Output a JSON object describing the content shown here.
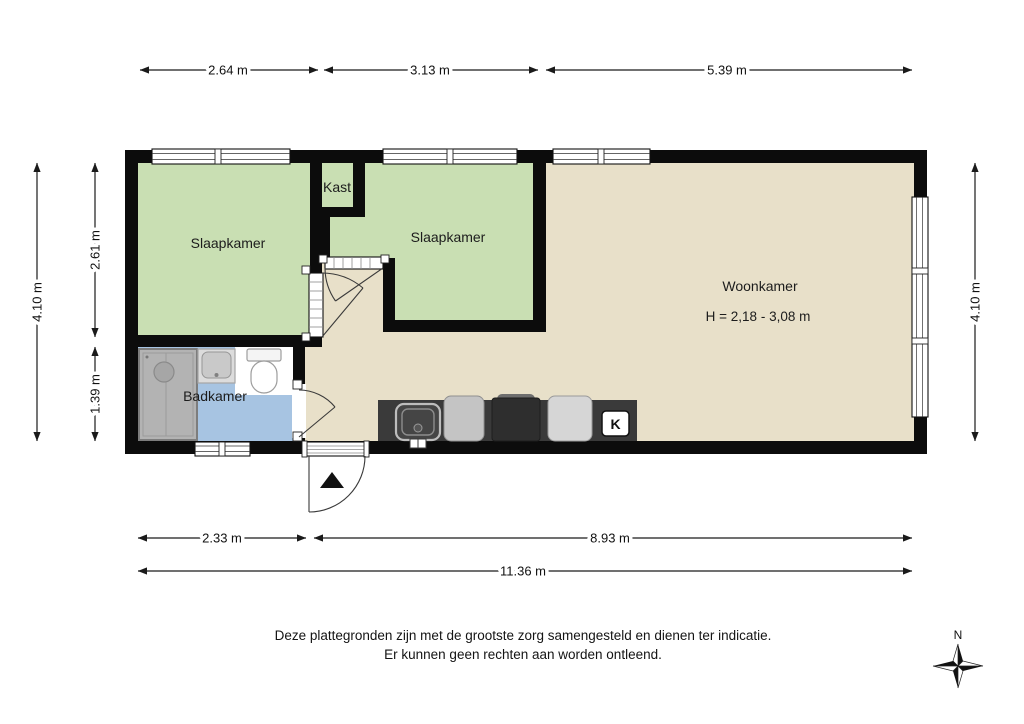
{
  "plan": {
    "rooms": {
      "slaapkamer_left": {
        "label": "Slaapkamer"
      },
      "kast": {
        "label": "Kast"
      },
      "slaapkamer_mid": {
        "label": "Slaapkamer"
      },
      "woonkamer": {
        "label": "Woonkamer",
        "height_note": "H = 2,18 - 3,08 m"
      },
      "badkamer": {
        "label": "Badkamer"
      }
    },
    "kitchen": {
      "boiler_label": "K"
    },
    "colors": {
      "wall": "#0c0c0c",
      "bedroom_green": "#c9dfb3",
      "living_beige": "#e8e0c9",
      "bathroom_blue": "#a7c4e2",
      "counter_dark": "#3a3a3a"
    }
  },
  "dimensions": {
    "top": [
      "2.64 m",
      "3.13 m",
      "5.39 m"
    ],
    "left_outer": "4.10 m",
    "left_inner": [
      "2.61 m",
      "1.39 m"
    ],
    "right": "4.10 m",
    "bottom_row": [
      "2.33 m",
      "8.93 m"
    ],
    "bottom_total": "11.36 m"
  },
  "compass": {
    "north_label": "N"
  },
  "footer": {
    "line1": "Deze plattegronden zijn met de grootste zorg samengesteld en dienen ter indicatie.",
    "line2": "Er kunnen geen rechten aan worden ontleend."
  }
}
